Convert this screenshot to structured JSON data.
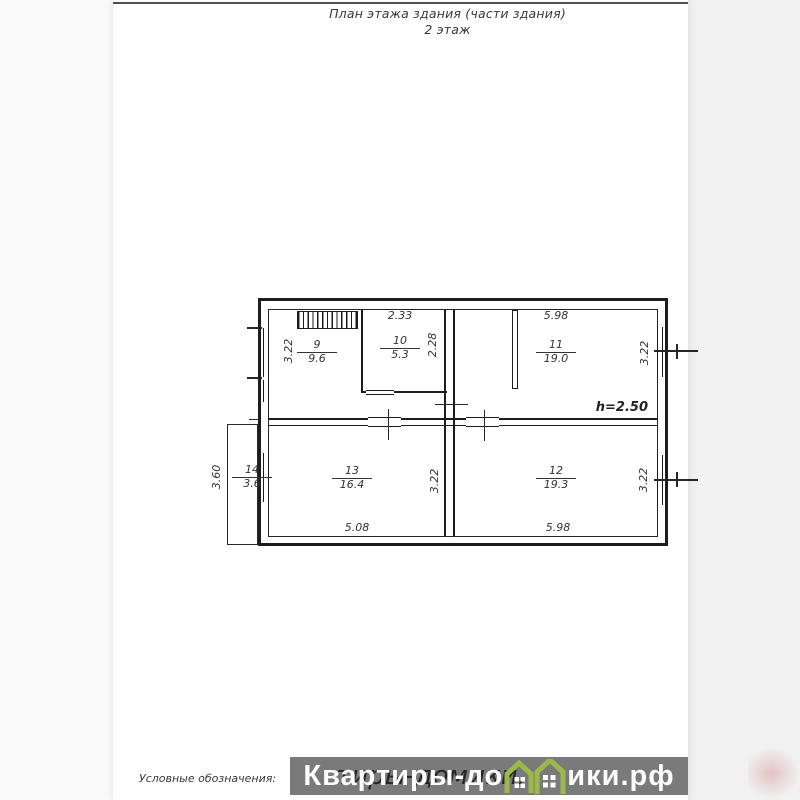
{
  "header": {
    "title": "План этажа здания (части здания)",
    "subtitle": "2 этаж"
  },
  "plan": {
    "height_note": "h=2.50",
    "rooms": [
      {
        "number": "9",
        "area": "9.6"
      },
      {
        "number": "10",
        "area": "5.3"
      },
      {
        "number": "11",
        "area": "19.0"
      },
      {
        "number": "12",
        "area": "19.3"
      },
      {
        "number": "13",
        "area": "16.4"
      },
      {
        "number": "14",
        "area": "3.6"
      }
    ],
    "dims": {
      "left_wall": "3.22",
      "room10_width": "2.33",
      "room10_height": "2.28",
      "room11_width": "5.98",
      "room11_height": "3.22",
      "room12_width": "5.98",
      "room12_height": "3.22",
      "room13_width": "5.08",
      "room13_height": "3.22",
      "balcony_height": "3.60"
    }
  },
  "footer": {
    "legend_label": "Условные обозначения:"
  },
  "watermark": {
    "text_before_icon": "Квартиры-до",
    "text_after_icon": "ики.рф",
    "full_text": "Квартиры-домики.рф",
    "shadow_text": "Квартиры-домики.рф",
    "band_color": "#7a7a7a",
    "brand_green": "#9cba4b",
    "icon": "houses-icon"
  }
}
